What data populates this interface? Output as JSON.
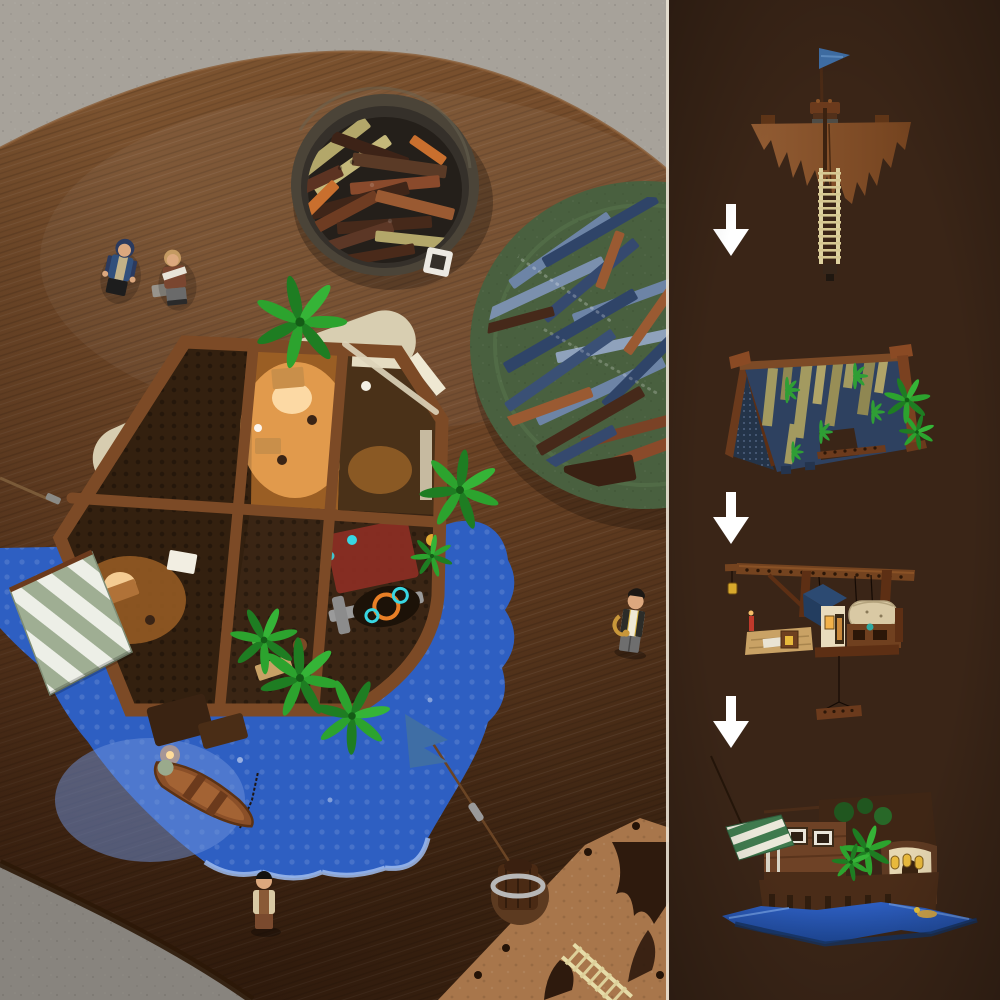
{
  "scene": {
    "type": "lego-product-photo",
    "left": {
      "name": "table-overview-photo",
      "elements": [
        {
          "name": "concrete-floor"
        },
        {
          "name": "walnut-oval-table"
        },
        {
          "name": "bowl-of-brown-bricks"
        },
        {
          "name": "plate-of-blue-and-brown-bricks"
        },
        {
          "name": "lying-minifigure-blue-hood"
        },
        {
          "name": "lying-minifigure-brown-coat"
        },
        {
          "name": "partially-built-harbor-house"
        },
        {
          "name": "blue-water-baseplate"
        },
        {
          "name": "beach-plates"
        },
        {
          "name": "green-white-striped-awning"
        },
        {
          "name": "palm-trees"
        },
        {
          "name": "rowboat-with-chain"
        },
        {
          "name": "standing-minifigure-with-saxophone"
        },
        {
          "name": "standing-minifigure-tan-jacket"
        },
        {
          "name": "mast-with-blue-pennant"
        },
        {
          "name": "ragged-sail-piece-with-ladders"
        }
      ]
    },
    "right": {
      "name": "build-steps-column",
      "steps": [
        {
          "order": 1,
          "name": "step-mast-flag-sail-ladder"
        },
        {
          "order": 2,
          "name": "step-a-frame-planked-roof"
        },
        {
          "order": 3,
          "name": "step-crane-dock-hut"
        },
        {
          "order": 4,
          "name": "step-finished-harbor-house"
        }
      ],
      "arrow_count": 3
    }
  },
  "palette": {
    "floor": "#a7a29a",
    "floor_shadow": "#716d65",
    "wood_light": "#7e5531",
    "wood": "#6b4325",
    "wood_dark": "#3b2311",
    "panel_bg": "#3a2517",
    "divider": "#e9e1d3",
    "arrow": "#ffffff",
    "water": "#2e5fc2",
    "water_deep": "#1c448f",
    "water_light": "#9fbcee",
    "sand": "#d8ceb1",
    "sand_light": "#e2d8bc",
    "frame_brown": "#7c4a26",
    "deck_dark": "#31200f",
    "lit_floor": "#9a5e24",
    "glow": "#ffb45e",
    "palm_green": "#2ca32e",
    "palm_dark": "#1e7d22",
    "awning_green": "#9fae93",
    "awning_white": "#edefe7",
    "bowl": "#4b4438",
    "bowl_inner": "#241f1a",
    "plate_green": "#49603f",
    "brick_tan": "#b3a76a",
    "brick_orange": "#c96f2e",
    "sand_blue": "#6d84a6",
    "dark_blue": "#2f4468",
    "reddish_brown": "#9a5a32",
    "sail_stage": "#8a5630",
    "sail_table": "#a8764b",
    "flag_blue": "#3f6ea5",
    "ladder_cream": "#ded2a0",
    "roof_navy": "#2e4160",
    "plank_olive": "#a39a60",
    "gantry_brown": "#74431f",
    "wall_cream": "#e9dcbd",
    "scroll_tan": "#d9c9a4",
    "window_yellow": "#e8b93c",
    "hull_brown": "#6e4226",
    "rug_red": "#8e2f23",
    "cyan_glow": "#38d6e2",
    "boat_brown": "#8a4f28",
    "skin": "#dca87e"
  }
}
